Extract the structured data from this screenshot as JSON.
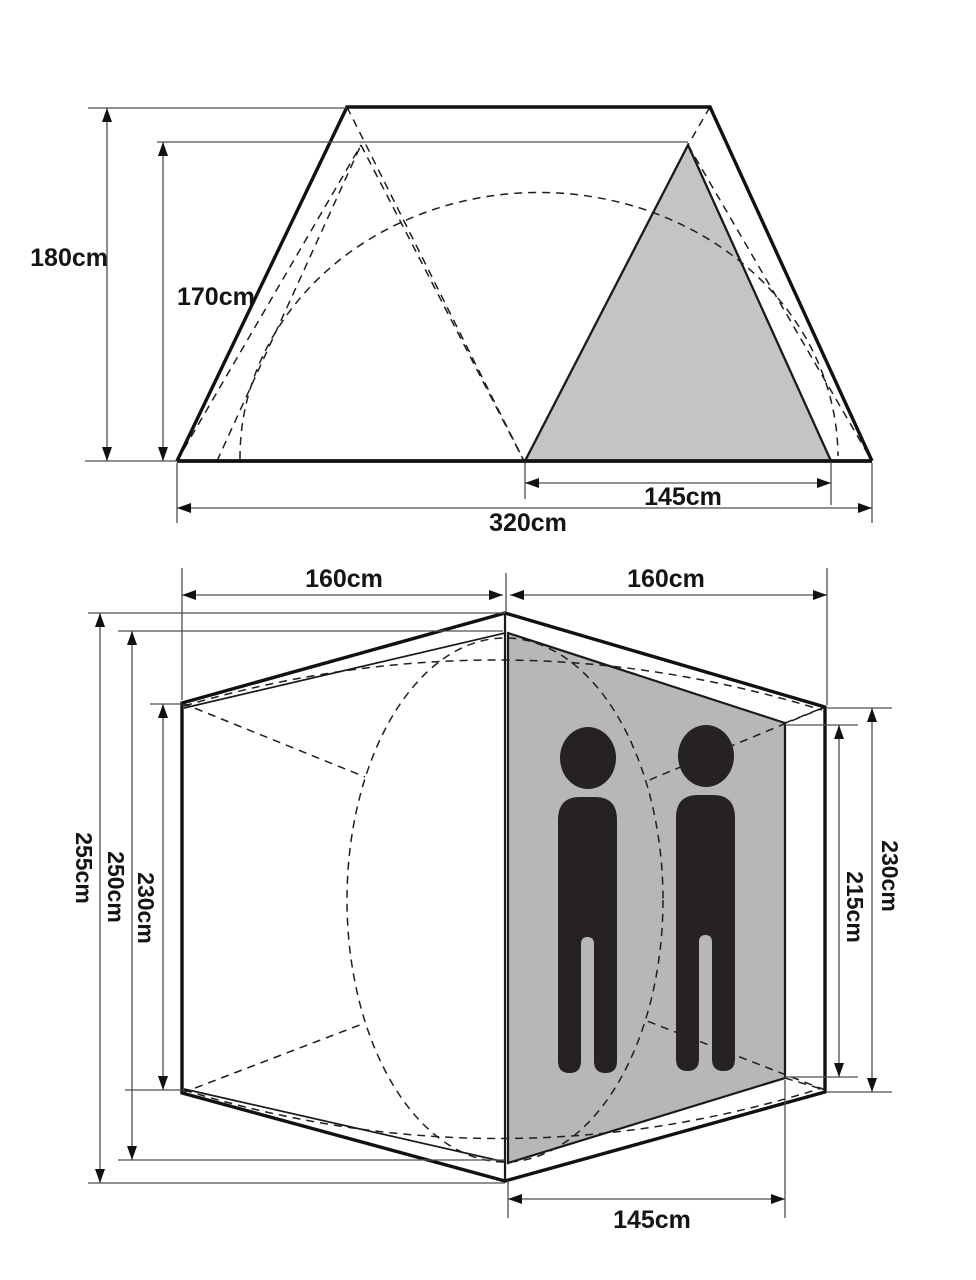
{
  "document": {
    "type": "tent dimension diagram",
    "views": [
      "side elevation",
      "floor plan"
    ]
  },
  "side_view": {
    "dims": {
      "outer_height": "180cm",
      "inner_height": "170cm",
      "inner_base_width": "145cm",
      "total_width": "320cm"
    }
  },
  "floor_plan": {
    "dims": {
      "half_width_left": "160cm",
      "half_width_right": "160cm",
      "total_length": "255cm",
      "inner_length": "250cm",
      "side_length_left": "230cm",
      "side_length_right": "230cm",
      "inner_side_length": "215cm",
      "inner_bottom_width": "145cm"
    },
    "occupant_count": 2
  },
  "colors": {
    "background": "#ffffff",
    "outline": "#111111",
    "dimension_line": "#4f4f4f",
    "shaded_side_view": "#c4c4c4",
    "shaded_floor_plan": "#b7b7b7",
    "silhouette": "#262224"
  }
}
